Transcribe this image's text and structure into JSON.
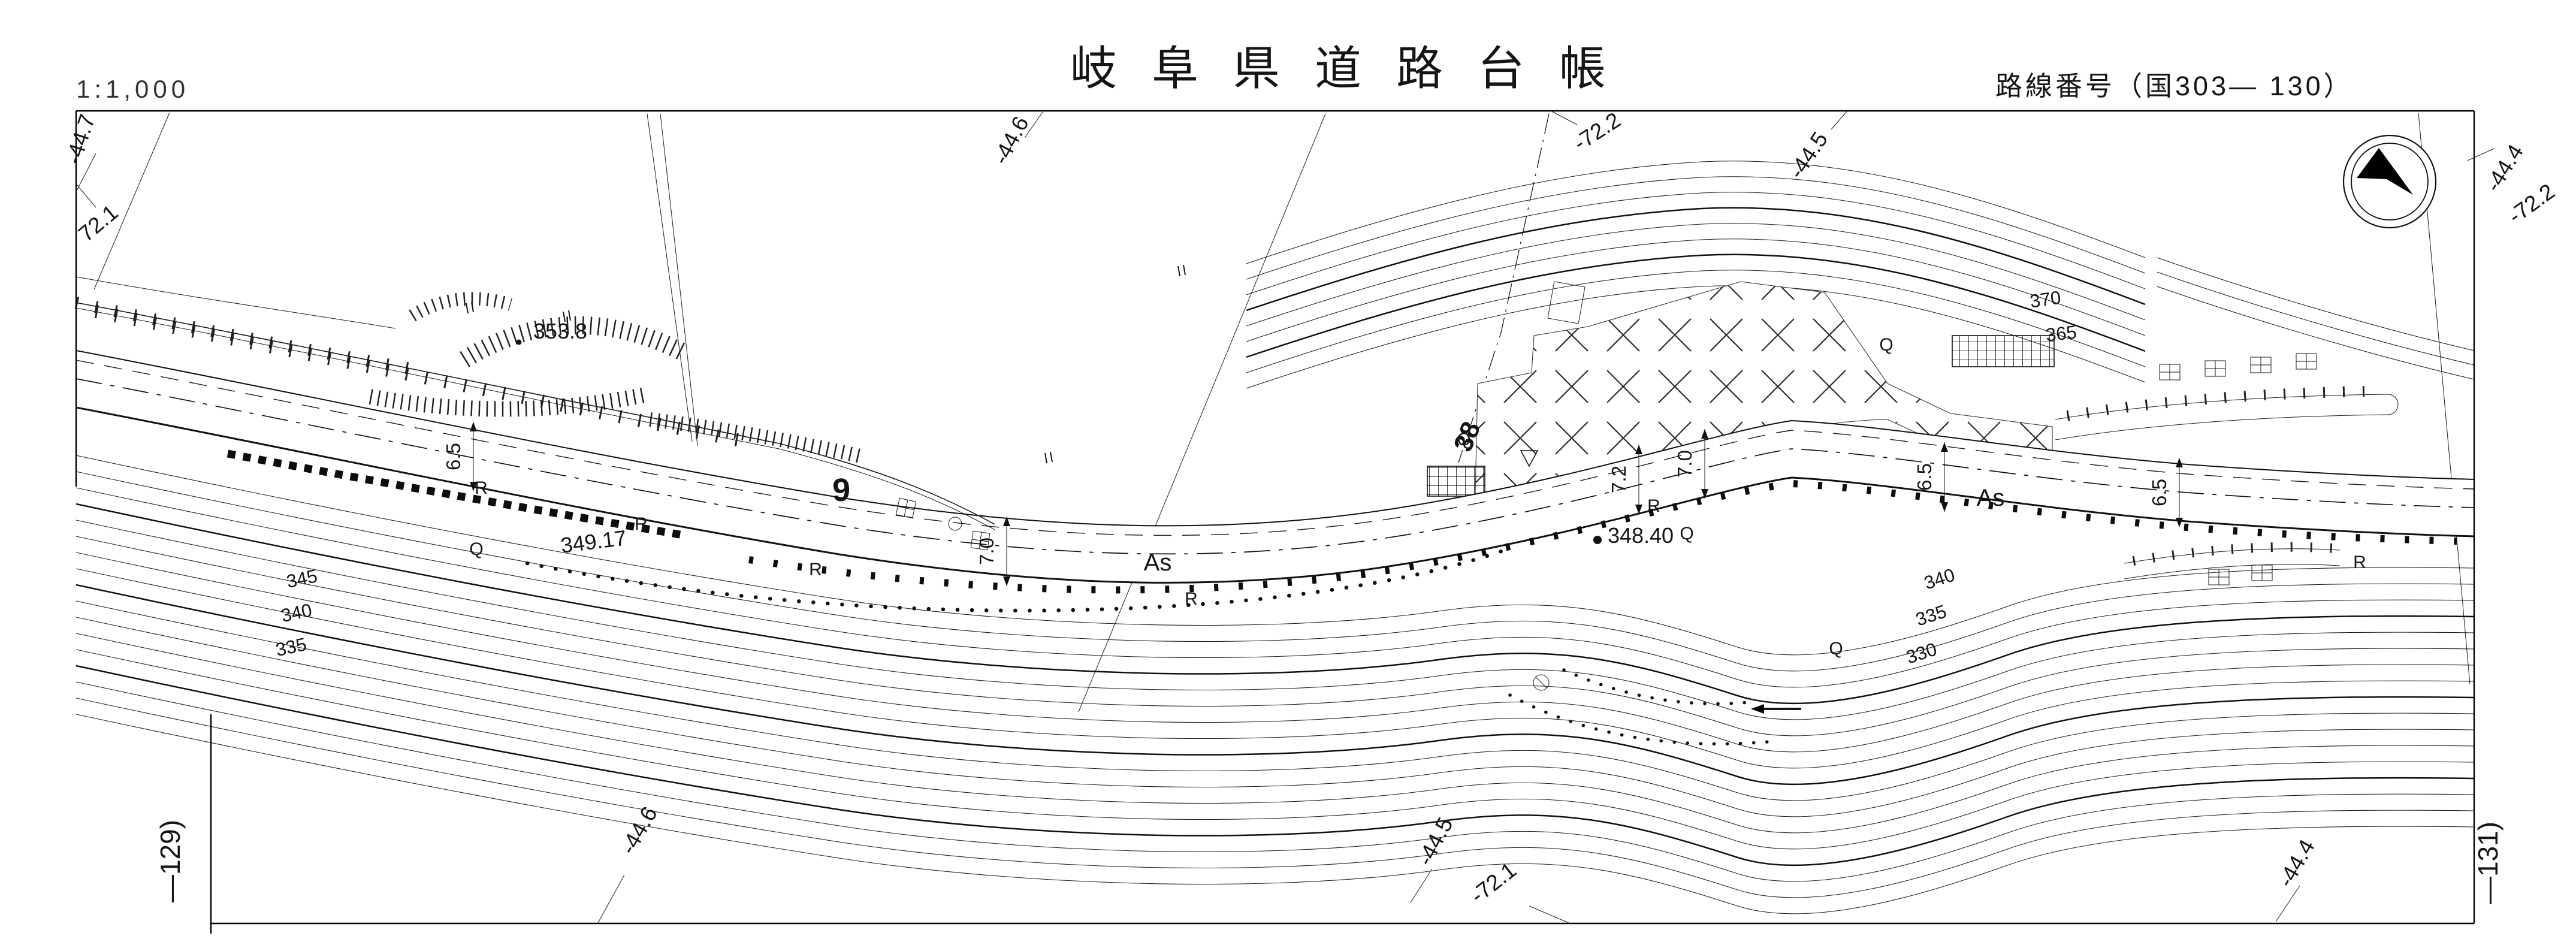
{
  "sheet": {
    "scale_label": "1:1,000",
    "title": "岐阜県道路台帳",
    "route_label": "路線番号（国303— 130）",
    "left_sheet_ref": "—129)",
    "right_sheet_ref": "—131)"
  },
  "icons": {
    "compass": "north-arrow-icon",
    "paddy_field": "paddy-field-icon",
    "benchmark": "triangle-benchmark-icon"
  },
  "grid_labels": [
    {
      "text": "-44.7"
    },
    {
      "text": "72.1"
    },
    {
      "text": "-44.6"
    },
    {
      "text": "-72.2"
    },
    {
      "text": "-44.5"
    },
    {
      "text": "-44.4"
    },
    {
      "text": "-72.2"
    },
    {
      "text": "-44.6"
    },
    {
      "text": "-44.5"
    },
    {
      "text": "-72.1"
    },
    {
      "text": "-44.4"
    }
  ],
  "elevations": {
    "spot": "353.8",
    "road_a": "349.17",
    "road_b": "348.40"
  },
  "contour_labels": [
    "345",
    "340",
    "335",
    "370",
    "365",
    "340",
    "335",
    "330"
  ],
  "stations": [
    "9",
    "38"
  ],
  "surface_labels": [
    "As",
    "As"
  ],
  "road_widths": [
    "6.5",
    "7.0",
    "7.2",
    "7.0",
    "6.5",
    "6.5"
  ],
  "marker_letters": {
    "retaining_wall": "R",
    "symbol_q": "Q"
  }
}
